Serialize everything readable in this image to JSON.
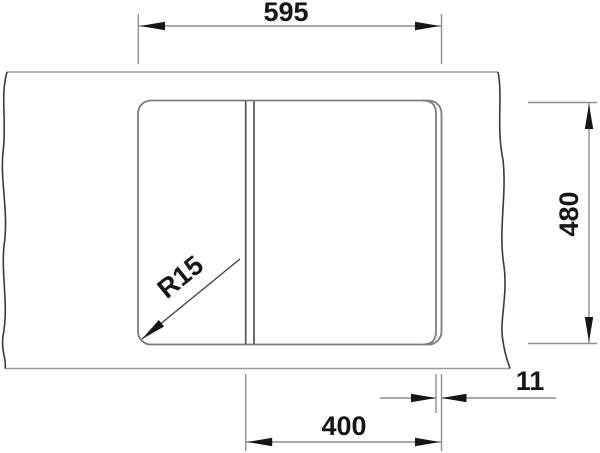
{
  "meta": {
    "drawing_type": "technical-dimension-drawing",
    "subject": "inset kitchen sink with divided bowl, top view on counter with break edges"
  },
  "dimensions": {
    "overall_width_mm": "595",
    "overall_depth_mm": "480",
    "bowl_width_mm": "400",
    "edge_offset_mm": "11",
    "corner_radius": "R15"
  },
  "colors": {
    "ink": "#161616",
    "thin_line": "#9a9a9a",
    "sink_outline": "#7d7d7d",
    "divider_line": "#555555",
    "break_line": "#3a3a3a",
    "background": "#ffffff"
  }
}
